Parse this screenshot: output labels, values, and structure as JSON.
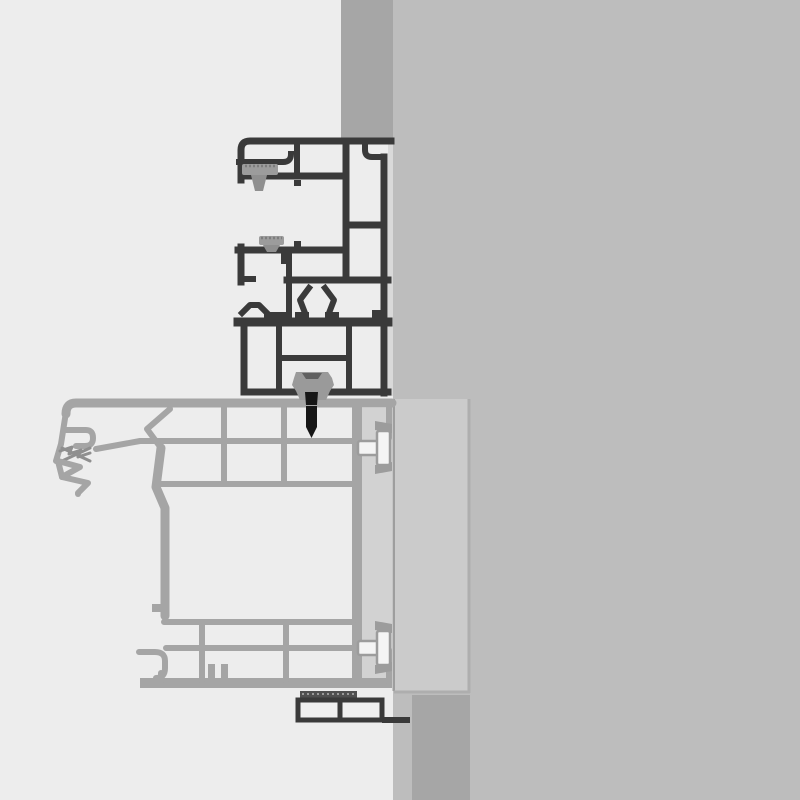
{
  "canvas": {
    "width": 800,
    "height": 800
  },
  "palette": {
    "bg": "#ededed",
    "wall": "#bdbdbd",
    "strip": "#a6a6a6",
    "insulation_panel": "#cbcbcb",
    "gap_panel": "#d2d2d2",
    "edge_seam": "#d9d9d9",
    "seam": "#9e9e9e",
    "seam_light": "#aeaeae",
    "profile_dark": "#3a3a3a",
    "profile_gray": "#a5a5a5",
    "profile_fill": "#efefef",
    "gasket": "#9c9c9c",
    "gasket_dark": "#7d7d7d",
    "claw": "#8f8f8f",
    "clip": "#9a9a9a",
    "clip_shadow": "#606060",
    "black": "#161616",
    "bolt_fill": "#f4f4f4",
    "hatch": "#4f4f4f",
    "hatch_line": "#9a9a9a"
  },
  "components": {
    "wall": "masonry-wall",
    "top_strip": "wall-reveal-strip-top",
    "bottom_strip": "wall-reveal-strip-bottom",
    "insulation": "insulation-panel",
    "upper_profile": "add-on-frame-profile",
    "lower_profile": "window-frame-profile",
    "gasket_upper": "brush-gasket-upper",
    "gasket_lower": "brush-gasket-lower",
    "center_gasket": "center-seal-gasket",
    "sill_gasket": "sill-claw-gasket",
    "clip": "connector-clip",
    "screw": "fastening-screw",
    "anchor_top": "wall-anchor-top",
    "anchor_bottom": "wall-anchor-bottom",
    "subsill": "subsill-profile",
    "thermal_break": "hatched-thermal-break"
  }
}
